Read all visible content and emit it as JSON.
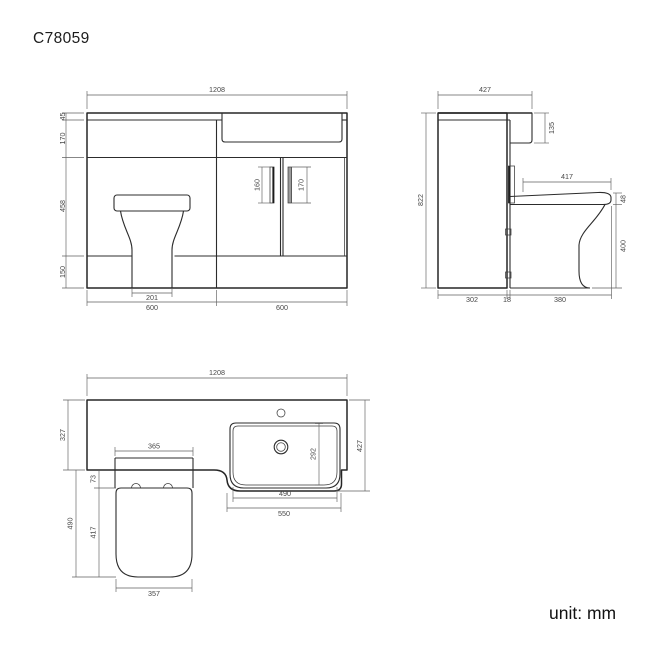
{
  "title": "C78059",
  "unit_label": "unit: mm",
  "colors": {
    "line": "#2c2c2c",
    "dim_text": "#474747",
    "handle_fill": "#9a9a9a"
  },
  "front_view": {
    "dims": {
      "overall_width": "1208",
      "worktop_height": "45",
      "upper_band": "170",
      "door_height": "458",
      "plinth_height": "150",
      "handle_left": "160",
      "handle_right": "170",
      "pan_base_width": "201",
      "wc_unit_width": "600",
      "basin_unit_width": "600"
    }
  },
  "side_view": {
    "dims": {
      "overall_depth": "427",
      "basin_depth": "135",
      "overall_height": "822",
      "seat_length": "417",
      "seat_thickness": "48",
      "pan_height": "400",
      "cabinet_depth": "302",
      "back_panel": "18",
      "pan_projection": "380"
    }
  },
  "plan_view": {
    "dims": {
      "overall_width": "1208",
      "worktop_depth": "327",
      "overall_depth": "427",
      "basin_inner_depth": "292",
      "basin_inner_width": "490",
      "basin_outer_width": "550",
      "cistern_width": "365",
      "seat_gap": "73",
      "seat_length": "417",
      "seat_projection": "490",
      "seat_front_width": "357"
    }
  }
}
